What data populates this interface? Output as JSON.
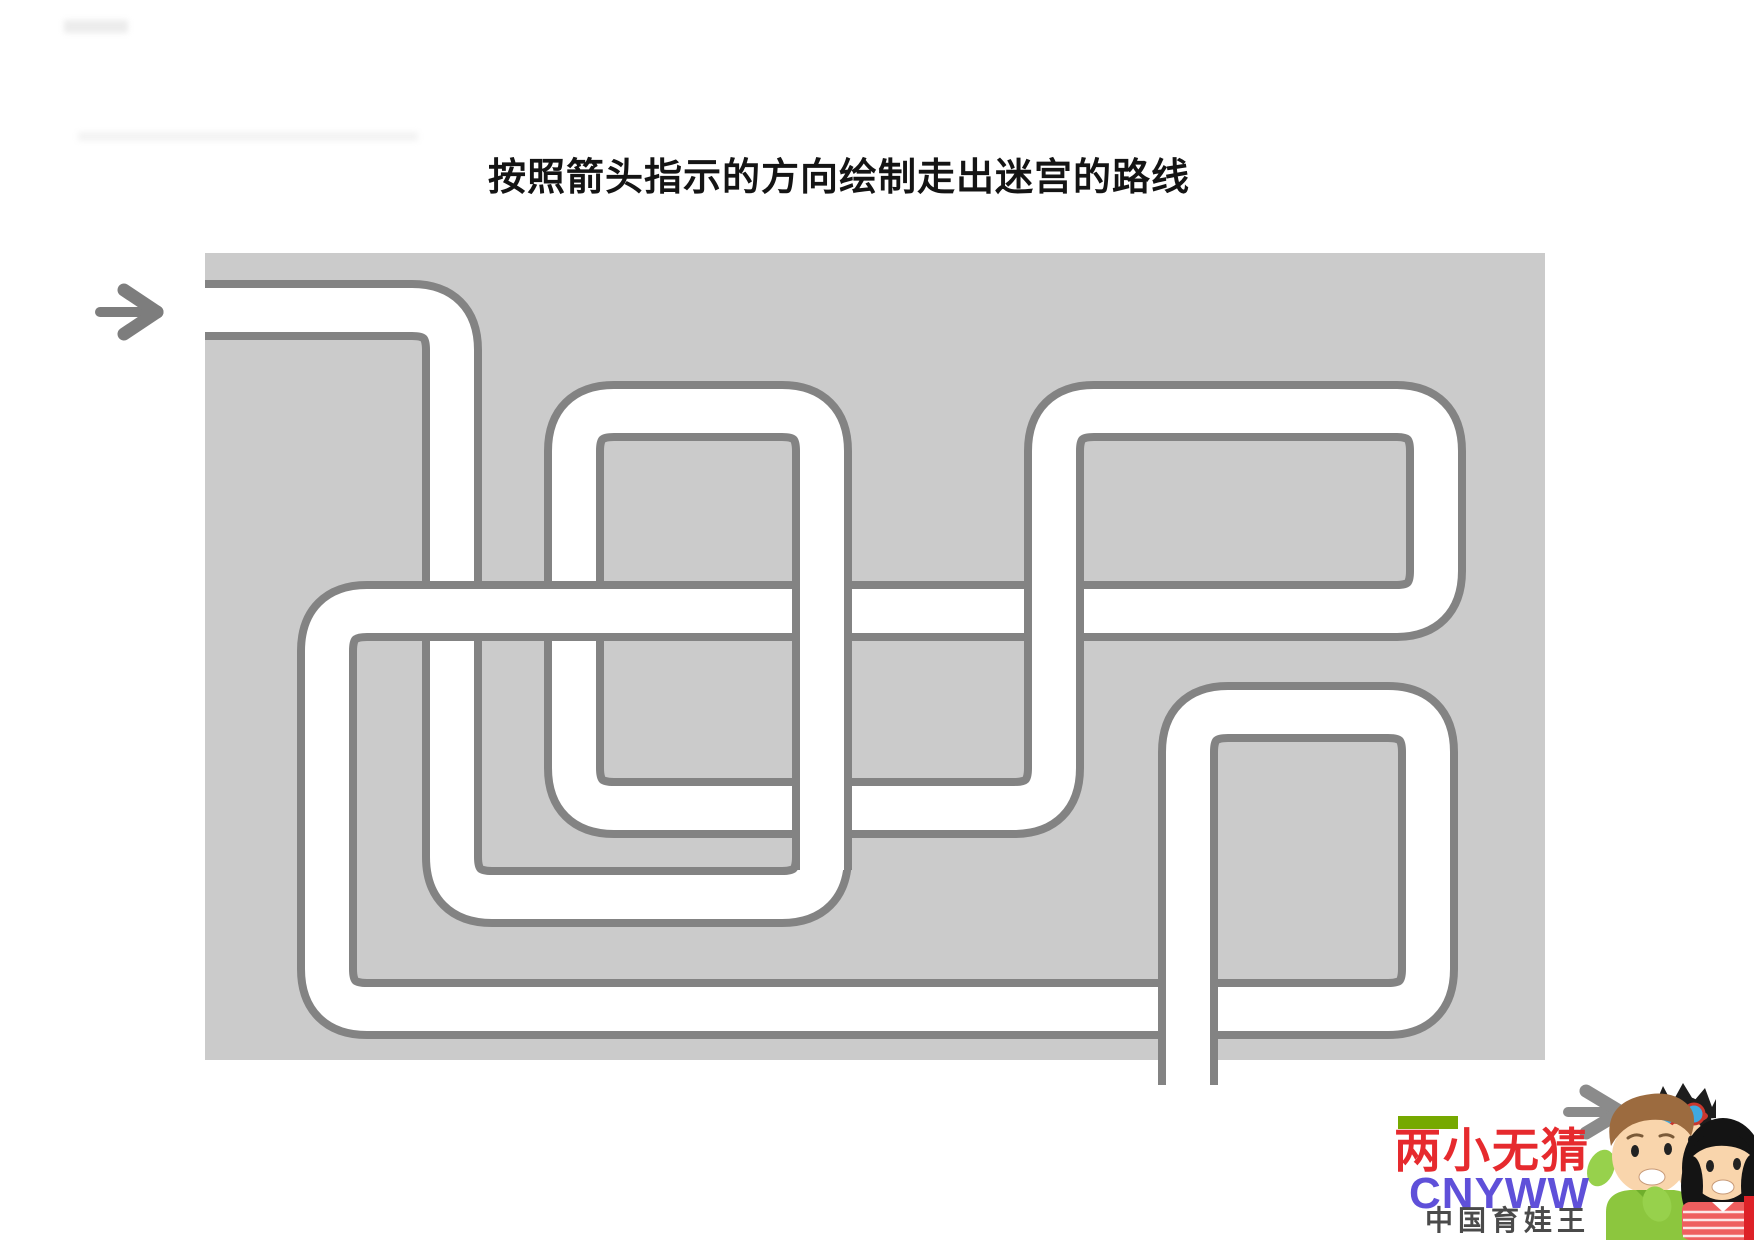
{
  "title": {
    "text": "按照箭头指示的方向绘制走出迷宫的路线"
  },
  "maze": {
    "bg_color": "#cbcbcb",
    "wall_color": "#838383",
    "path_color": "#ffffff",
    "rect": {
      "x": 205,
      "y": 253,
      "w": 1340,
      "h": 807
    },
    "pipe": {
      "outer_width": 60,
      "inner_width": 44,
      "corner_radius": 40,
      "waypoints": [
        [
          205,
          310
        ],
        [
          452,
          310
        ],
        [
          452,
          897
        ],
        [
          822,
          897
        ],
        [
          822,
          411
        ],
        [
          574,
          411
        ],
        [
          574,
          808
        ],
        [
          1054,
          808
        ],
        [
          1054,
          411
        ],
        [
          1436,
          411
        ],
        [
          1436,
          611
        ],
        [
          327,
          611
        ],
        [
          327,
          1009
        ],
        [
          1428,
          1009
        ],
        [
          1428,
          712
        ],
        [
          1188,
          712
        ],
        [
          1188,
          1085
        ]
      ],
      "overpasses": [
        [
          380,
          611,
          660,
          611
        ],
        [
          822,
          550,
          822,
          870
        ],
        [
          1054,
          550,
          1054,
          675
        ],
        [
          1188,
          940,
          1188,
          1085
        ]
      ]
    },
    "entry_arrow": {
      "color": "#7d7d7d",
      "shaft": [
        100,
        312,
        146,
        312
      ],
      "head": [
        [
          124,
          290,
          157,
          312
        ],
        [
          124,
          334,
          157,
          312
        ]
      ]
    },
    "exit_arrow": {
      "color": "#8b8b8b",
      "shaft": [
        1568,
        1112,
        1610,
        1112
      ],
      "head": [
        [
          1586,
          1091,
          1621,
          1112
        ],
        [
          1586,
          1133,
          1621,
          1112
        ]
      ]
    }
  },
  "watermark": {
    "brand_cn": "两小无猜",
    "brand_cn_color": "#e62a2e",
    "brand_en": "CNYWW",
    "brand_en_color": "#5f50d9",
    "tagline": "中国育娃王",
    "tagline_color": "#4a4a4a",
    "green_bar_color": "#76a900",
    "red_bar_color": "#dd2127",
    "skin_color": "#f9d5ac",
    "man_hair_color": "#9c6b3f",
    "man_shirt_color": "#8cc63e",
    "hand_color": "#97d14c",
    "boy_hair_color": "#1d1d1d",
    "goggle_lens_color": "#3fa9e0",
    "goggle_frame_color": "#c9372e",
    "woman_hair_color": "#141414",
    "woman_shirt_color": "#ee5f5f"
  }
}
